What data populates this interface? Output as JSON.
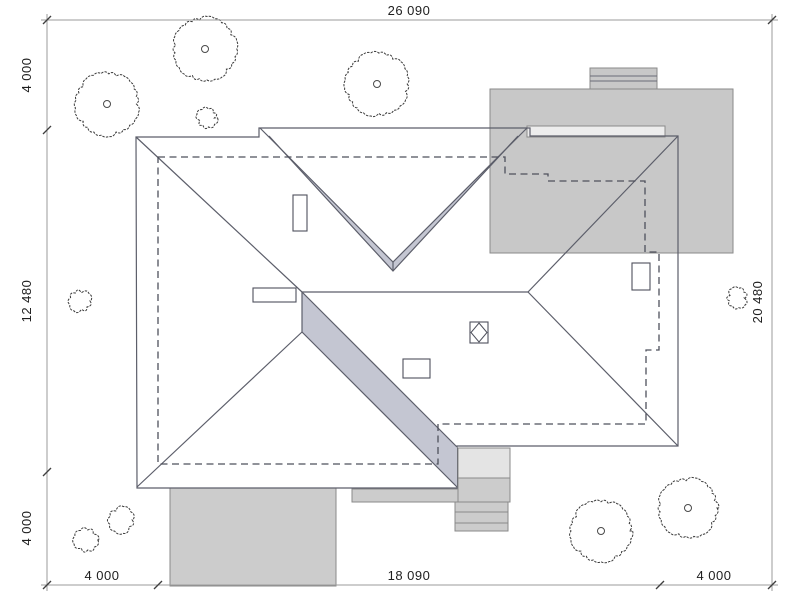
{
  "plan": {
    "title": "roof-site-plan",
    "dimensions": {
      "top": [
        "26 090"
      ],
      "left": [
        "4 000",
        "12 480",
        "4 000"
      ],
      "right": [
        "20 480"
      ],
      "bottom": [
        "4 000",
        "18 090",
        "4 000"
      ]
    },
    "colors": {
      "background": "#ffffff",
      "roof": "#b2b4c3",
      "roof_fascia": "#c4c6d2",
      "roof_line": "#5c5e6a",
      "outbuilding": "#c8c8c8",
      "outbuilding_strip": "#ededed",
      "paving": "#cccccc",
      "terrace_light": "#e4e4e4",
      "dimension_text": "#1e1e1e"
    },
    "trees": [
      {
        "x": 107,
        "y": 104,
        "r": 31,
        "kind": "tree"
      },
      {
        "x": 205,
        "y": 49,
        "r": 31,
        "kind": "tree"
      },
      {
        "x": 377,
        "y": 84,
        "r": 31,
        "kind": "tree"
      },
      {
        "x": 207,
        "y": 118,
        "r": 9,
        "kind": "bush"
      },
      {
        "x": 80,
        "y": 301,
        "r": 10,
        "kind": "bush"
      },
      {
        "x": 737,
        "y": 298,
        "r": 9,
        "kind": "bush"
      },
      {
        "x": 86,
        "y": 540,
        "r": 11,
        "kind": "bush"
      },
      {
        "x": 121,
        "y": 520,
        "r": 12,
        "kind": "bush"
      },
      {
        "x": 601,
        "y": 531,
        "r": 30,
        "kind": "tree"
      },
      {
        "x": 688,
        "y": 508,
        "r": 29,
        "kind": "tree"
      }
    ]
  }
}
